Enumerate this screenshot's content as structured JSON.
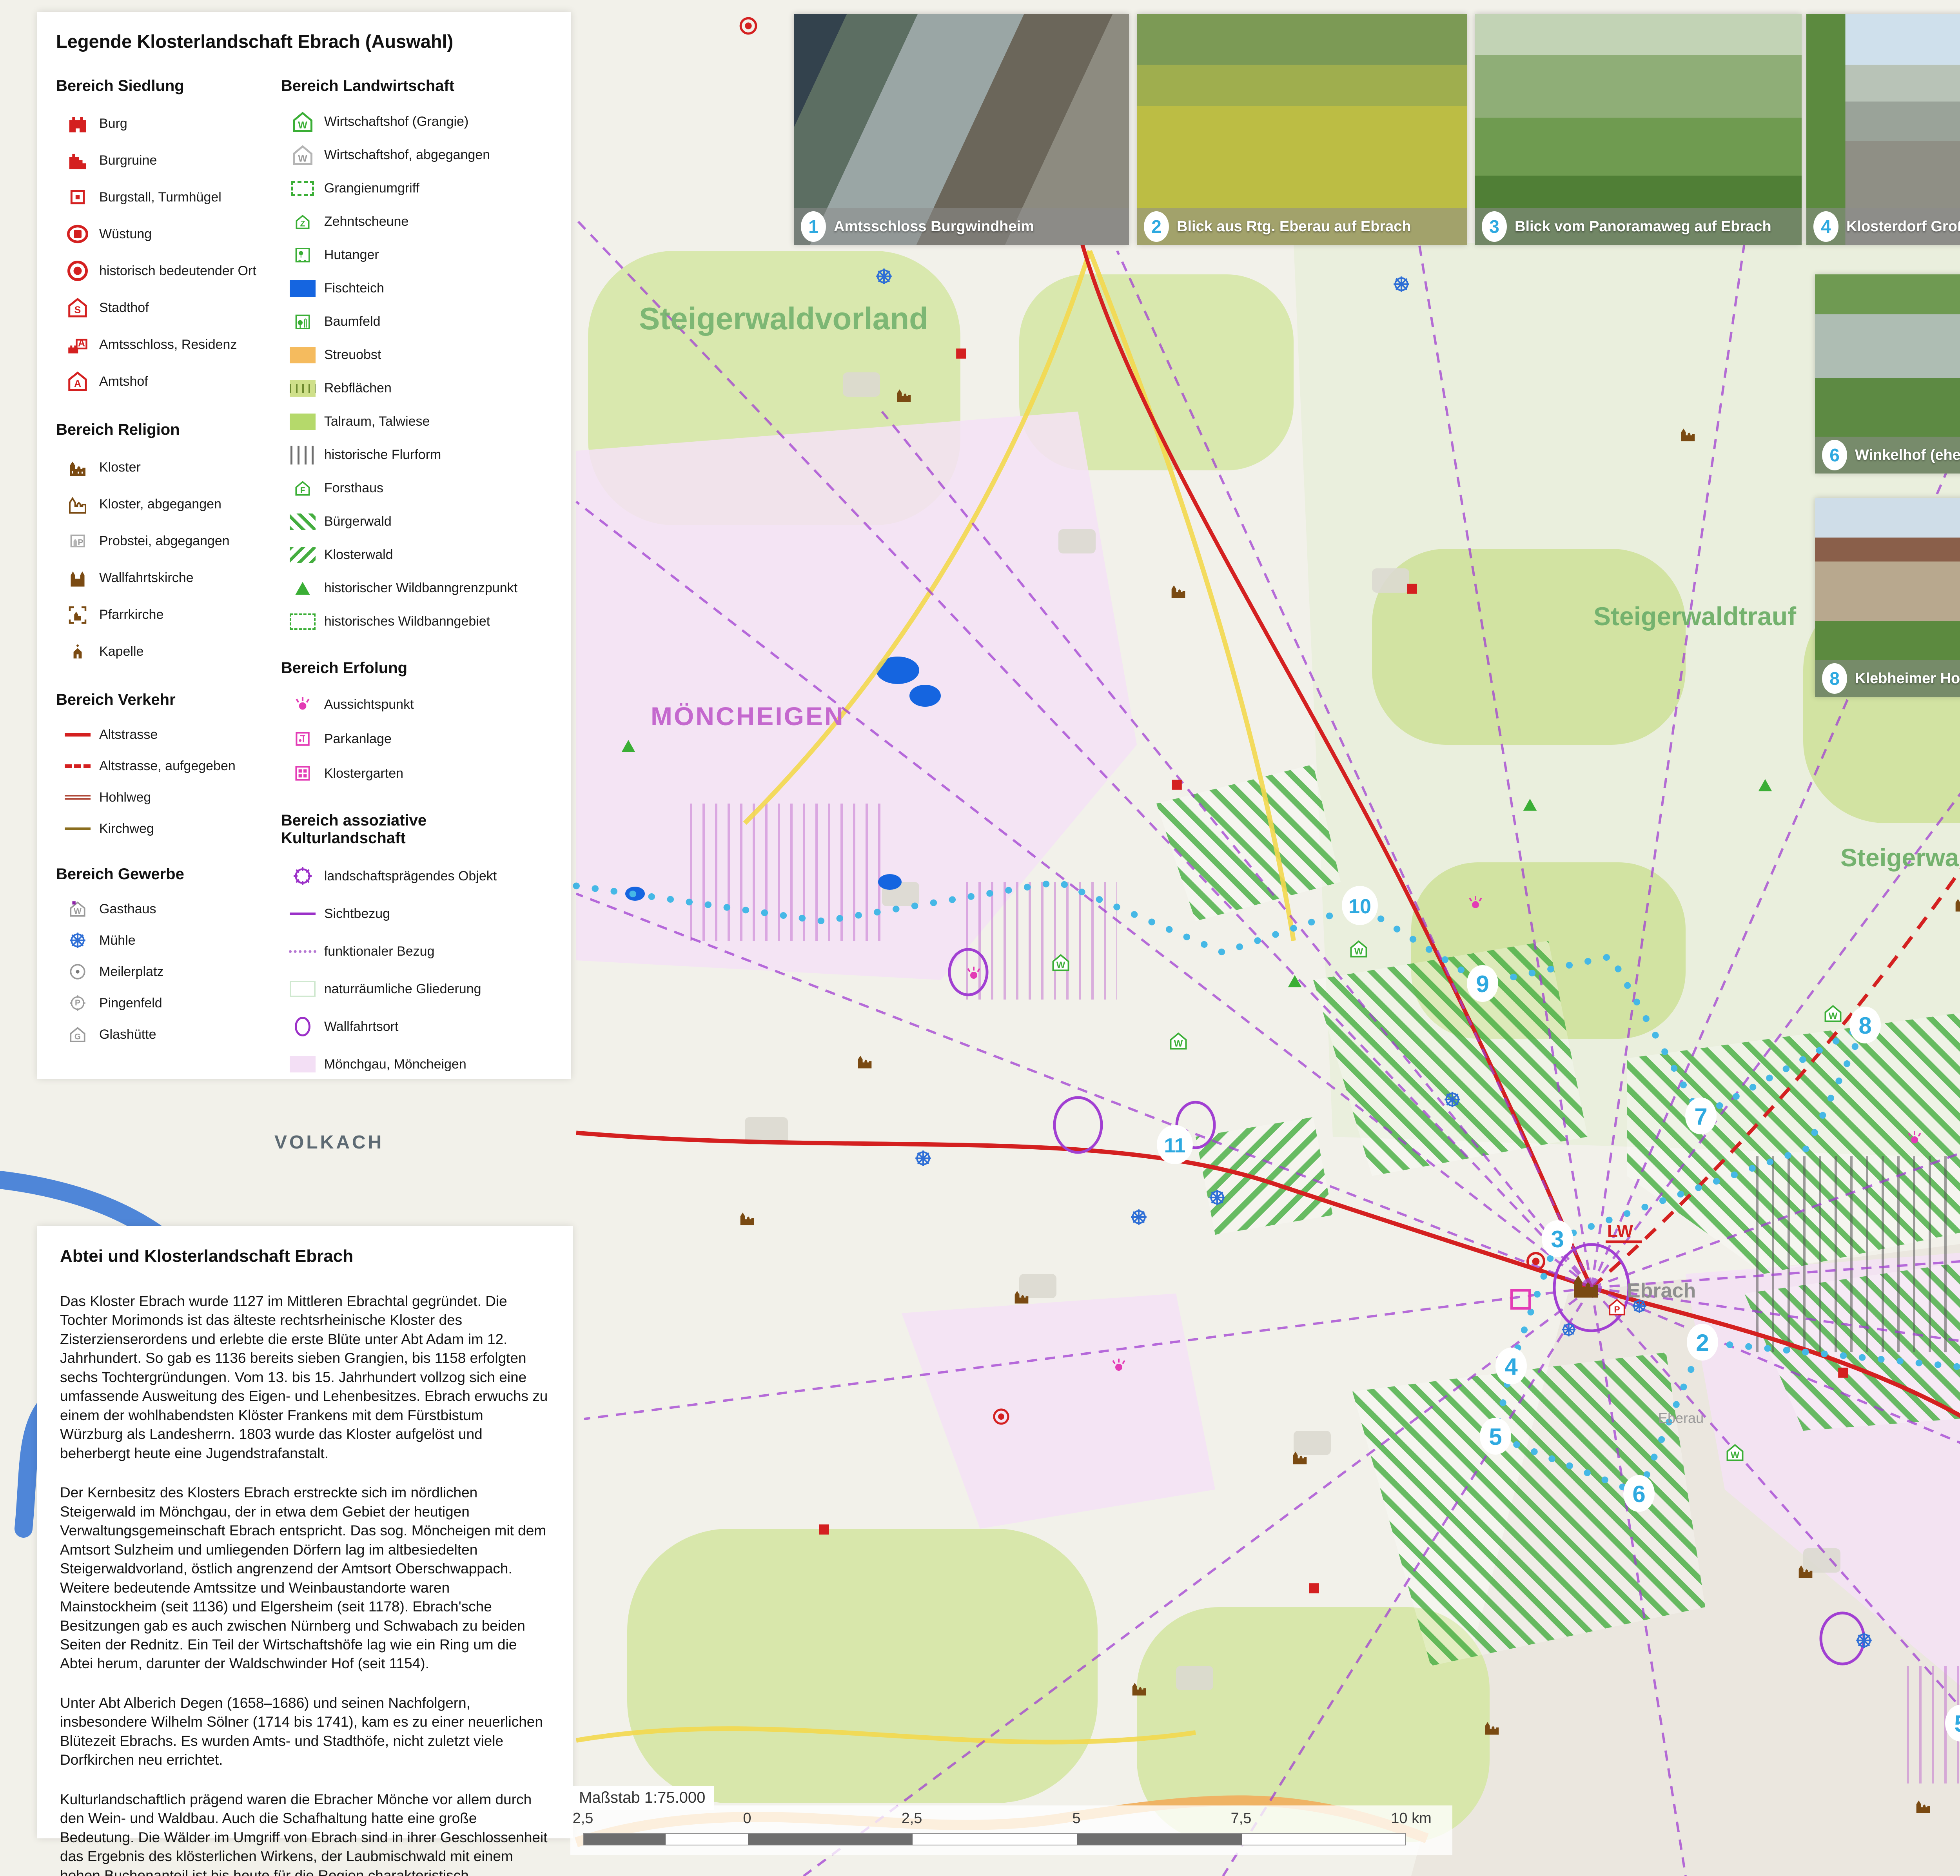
{
  "colors": {
    "legend_red": "#d42020",
    "legend_brown": "#7a4a12",
    "legend_green": "#3aae35",
    "legend_magenta": "#e33bb5",
    "legend_purple": "#9b30c8",
    "legend_blue": "#1565e0",
    "route_blue": "#45b8e6",
    "marker_blue": "#2ea9e0",
    "region_green": "#74b26e",
    "region_violet": "#c468ce",
    "moenchgau_fill": "#f3dff5",
    "streuobst": "#f5bb5e"
  },
  "icons": {
    "w": "W",
    "z": "Z",
    "f": "F",
    "p": "P",
    "g": "G",
    "s": "S",
    "a": "A"
  },
  "legend": {
    "title": "Legende Klosterlandschaft Ebrach (Auswahl)",
    "sections": {
      "siedlung": {
        "heading": "Bereich Siedlung",
        "items": [
          "Burg",
          "Burgruine",
          "Burgstall, Turmhügel",
          "Wüstung",
          "historisch bedeutender Ort",
          "Stadthof",
          "Amtsschloss, Residenz",
          "Amtshof"
        ]
      },
      "religion": {
        "heading": "Bereich Religion",
        "items": [
          "Kloster",
          "Kloster, abgegangen",
          "Probstei, abgegangen",
          "Wallfahrtskirche",
          "Pfarrkirche",
          "Kapelle"
        ]
      },
      "verkehr": {
        "heading": "Bereich Verkehr",
        "items": [
          "Altstrasse",
          "Altstrasse, aufgegeben",
          "Hohlweg",
          "Kirchweg"
        ]
      },
      "gewerbe": {
        "heading": "Bereich Gewerbe",
        "items": [
          "Gasthaus",
          "Mühle",
          "Meilerplatz",
          "Pingenfeld",
          "Glashütte"
        ]
      },
      "landwirtschaft": {
        "heading": "Bereich Landwirtschaft",
        "items": [
          "Wirtschaftshof (Grangie)",
          "Wirtschaftshof, abgegangen",
          "Grangienumgriff",
          "Zehntscheune",
          "Hutanger",
          "Fischteich",
          "Baumfeld",
          "Streuobst",
          "Rebflächen",
          "Talraum, Talwiese",
          "historische Flurform",
          "Forsthaus",
          "Bürgerwald",
          "Klosterwald",
          "historischer Wildbanngrenzpunkt",
          "historisches Wildbanngebiet"
        ]
      },
      "erholung": {
        "heading": "Bereich Erfolung",
        "items": [
          "Aussichtspunkt",
          "Parkanlage",
          "Klostergarten"
        ]
      },
      "assoziativ": {
        "heading": "Bereich assoziative Kulturlandschaft",
        "items": [
          "landschaftsprägendes Objekt",
          "Sichtbezug",
          "funktionaler Bezug",
          "naturräumliche Gliederung",
          "Wallfahrtsort",
          "Mönchgau, Möncheigen"
        ]
      },
      "exkursion": {
        "heading": "Exkursion",
        "items": [
          "Routenverlauf"
        ]
      }
    },
    "credits": [
      "Planzeichen: © ABURO 2018",
      "Kartengrundlage: © BEV, bergfex.at 2008, 2015"
    ]
  },
  "photos": [
    {
      "number": "1",
      "caption": "Amtsschloss Burgwindheim"
    },
    {
      "number": "2",
      "caption": "Blick aus Rtg. Eberau auf Ebrach"
    },
    {
      "number": "3",
      "caption": "Blick vom Panoramaweg auf Ebrach"
    },
    {
      "number": "4",
      "caption": "Klosterdorf Großgressingen"
    },
    {
      "number": "5",
      "caption": "St. Rochus und das ehem. Siechenhaus"
    },
    {
      "number": "6",
      "caption": "Winkelhof (ehem. Grangie)"
    },
    {
      "number": "7",
      "caption": "Klosterdorf Neudorf bei Ebrach"
    },
    {
      "number": "8",
      "caption": "Klebheimer Hof (ehem. Grangie)"
    },
    {
      "number": "9",
      "caption": "Waldschwinder Hof (ehem. Grangie)"
    },
    {
      "number": "10",
      "caption": "Pingenfeld westlich von Waldschwind"
    },
    {
      "number": "11",
      "caption": "Blick aus Rtg. der Stollburg auf den Steigerwaldtrauf"
    }
  ],
  "map": {
    "region_labels": {
      "steigerwaldvorland": "Steigerwaldvorland",
      "moencheigen": "MÖNCHEIGEN",
      "steigerwaldtrauf": "Steigerwaldtrauf",
      "hochflaeche": "Steigerwald-Hochfläche",
      "moenchgau": "MÖNCHGAU"
    },
    "place_labels": {
      "volkach": "VOLKACH",
      "ebrach": "Ebrach",
      "eberau": "Eberau",
      "burgwindheim": "Burgwindheim",
      "lw": "LW",
      "contour": "300"
    },
    "route_markers": [
      "1",
      "2",
      "3",
      "4",
      "5",
      "6",
      "7",
      "8",
      "9",
      "10",
      "11",
      "5"
    ]
  },
  "scalebar": {
    "label": "Maßstab 1:75.000",
    "ticks": [
      "2,5",
      "0",
      "2,5",
      "5",
      "7,5",
      "10 km"
    ]
  },
  "article": {
    "title": "Abtei und Klosterlandschaft Ebrach",
    "paragraphs": [
      "Das Kloster Ebrach wurde 1127 im Mittleren Ebrachtal gegründet. Die Tochter Morimonds ist das älteste rechtsrheinische Kloster des Zisterzienserordens und erlebte die erste Blüte unter Abt Adam im 12. Jahrhundert. So gab es 1136 bereits sieben Grangien, bis 1158 erfolgten sechs Tochtergründungen. Vom 13. bis 15. Jahrhundert vollzog sich eine umfassende Ausweitung des Eigen- und Lehenbesitzes. Ebrach erwuchs zu einem der wohlhabendsten Klöster Frankens mit dem Fürstbistum Würzburg als Landesherrn. 1803 wurde das Kloster aufgelöst und beherbergt heute eine Jugendstrafanstalt.",
      "Der Kernbesitz des Klosters Ebrach erstreckte sich im nördlichen Steigerwald im Mönchgau, der in etwa dem Gebiet der heutigen Verwaltungsgemeinschaft Ebrach entspricht. Das sog. Möncheigen mit dem Amtsort Sulzheim und umliegenden Dörfern lag im altbesiedelten Steigerwaldvorland, östlich angrenzend der Amtsort Oberschwappach. Weitere bedeutende Amtssitze und Weinbaustandorte waren Mainstockheim (seit 1136) und Elgersheim (seit 1178). Ebrach'sche Besitzungen gab es auch zwischen Nürnberg und Schwabach zu beiden Seiten der Rednitz. Ein Teil der Wirtschaftshöfe lag wie ein Ring um die Abtei herum, darunter der Waldschwinder Hof (seit 1154).",
      "Unter Abt Alberich Degen (1658–1686) und seinen Nachfolgern, insbesondere Wilhelm Sölner (1714 bis 1741), kam es zu einer neuerlichen Blütezeit Ebrachs. Es wurden Amts- und Stadthöfe, nicht zuletzt viele Dorfkirchen neu errichtet.",
      "Kulturlandschaftlich prägend waren die Ebracher Mönche vor allem durch den Wein- und Waldbau. Auch die Schafhaltung hatte eine große Bedeutung. Die Wälder im Umgriff von Ebrach sind in ihrer Geschlossenheit das Ergebnis des klösterlichen Wirkens, der Laubmischwald mit einem hohen Buchenanteil ist bis heute für die Region charakteristisch."
    ]
  }
}
